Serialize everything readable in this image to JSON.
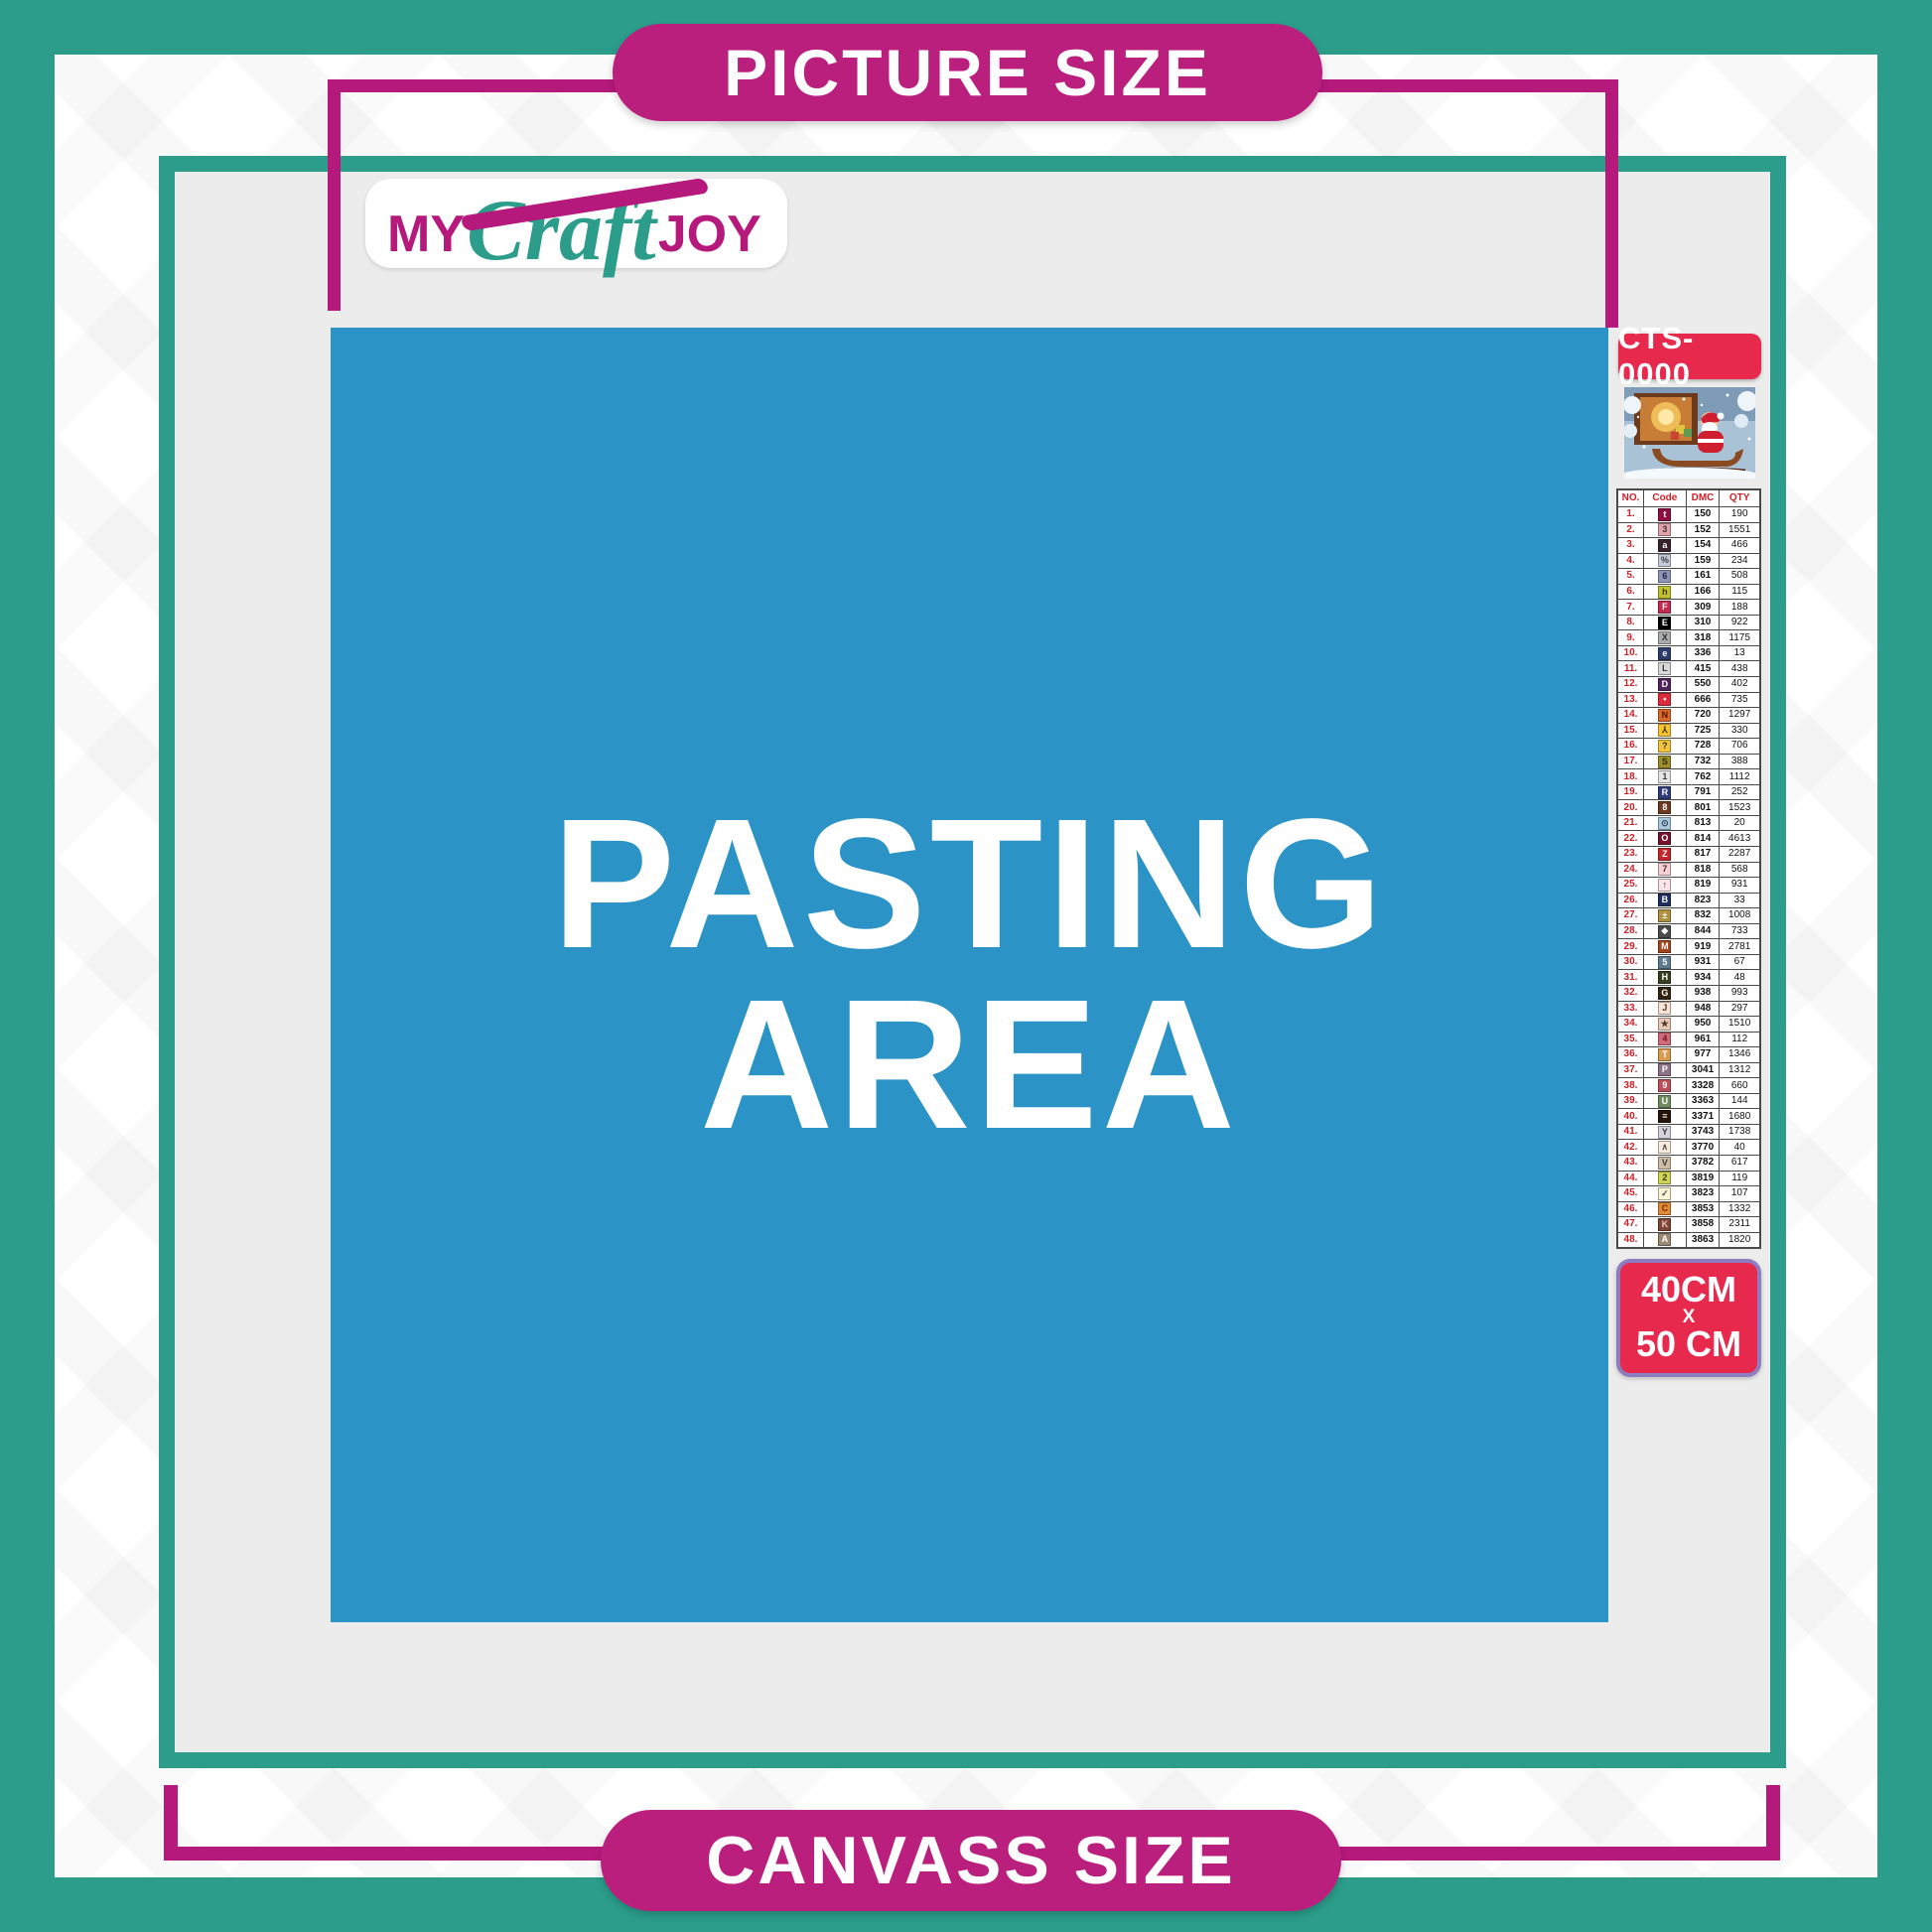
{
  "banners": {
    "top": "PICTURE SIZE",
    "bottom": "CANVASS SIZE"
  },
  "logo": {
    "word1": "MY",
    "word2": "Craft",
    "word3": "JOY"
  },
  "pasting_area": {
    "line1": "PASTING",
    "line2": "AREA"
  },
  "product": {
    "sku": "CTS-0000",
    "size_width": "40CM",
    "size_separator": "X",
    "size_height": "50 CM",
    "thumbnail": "santa-sleigh-christmas-scene"
  },
  "colors": {
    "teal_frame": "#2b9d8a",
    "magenta_accent": "#b5197c",
    "pill_magenta": "#bb1f7e",
    "pasting_blue": "#2b93c5",
    "badge_red": "#e8294e",
    "badge_border_purple": "#8d7cc0",
    "canvas_gray": "#ececec",
    "table_header_red": "#cc2027"
  },
  "color_table": {
    "headers": [
      "NO.",
      "Code",
      "DMC",
      "QTY"
    ],
    "rows": [
      {
        "no": "1.",
        "symbol": "t",
        "bg": "#8e1043",
        "fg": "#ffffff",
        "dmc": "150",
        "qty": "190"
      },
      {
        "no": "2.",
        "symbol": "3",
        "bg": "#e0a3a8",
        "fg": "#3a3a3a",
        "dmc": "152",
        "qty": "1551"
      },
      {
        "no": "3.",
        "symbol": "a",
        "bg": "#38222e",
        "fg": "#ffffff",
        "dmc": "154",
        "qty": "466"
      },
      {
        "no": "4.",
        "symbol": "%",
        "bg": "#c6cada",
        "fg": "#3a3a3a",
        "dmc": "159",
        "qty": "234"
      },
      {
        "no": "5.",
        "symbol": "6",
        "bg": "#8e96b8",
        "fg": "#1d2440",
        "dmc": "161",
        "qty": "508"
      },
      {
        "no": "6.",
        "symbol": "h",
        "bg": "#bfc22e",
        "fg": "#3a3a00",
        "dmc": "166",
        "qty": "115"
      },
      {
        "no": "7.",
        "symbol": "F",
        "bg": "#c22a50",
        "fg": "#ffffff",
        "dmc": "309",
        "qty": "188"
      },
      {
        "no": "8.",
        "symbol": "E",
        "bg": "#000000",
        "fg": "#ffffff",
        "dmc": "310",
        "qty": "922"
      },
      {
        "no": "9.",
        "symbol": "X",
        "bg": "#aaacae",
        "fg": "#2e2e2e",
        "dmc": "318",
        "qty": "1175"
      },
      {
        "no": "10.",
        "symbol": "e",
        "bg": "#2c3b6c",
        "fg": "#ffffff",
        "dmc": "336",
        "qty": "13"
      },
      {
        "no": "11.",
        "symbol": "L",
        "bg": "#d7d8da",
        "fg": "#3a3a3a",
        "dmc": "415",
        "qty": "438"
      },
      {
        "no": "12.",
        "symbol": "D",
        "bg": "#50215b",
        "fg": "#ffffff",
        "dmc": "550",
        "qty": "402"
      },
      {
        "no": "13.",
        "symbol": "•",
        "bg": "#dd2b3b",
        "fg": "#ffffff",
        "dmc": "666",
        "qty": "735"
      },
      {
        "no": "14.",
        "symbol": "N",
        "bg": "#d9692a",
        "fg": "#571403",
        "dmc": "720",
        "qty": "1297"
      },
      {
        "no": "15.",
        "symbol": "⅄",
        "bg": "#f5c231",
        "fg": "#3d2f00",
        "dmc": "725",
        "qty": "330"
      },
      {
        "no": "16.",
        "symbol": "?",
        "bg": "#f1c43e",
        "fg": "#3d2f00",
        "dmc": "728",
        "qty": "706"
      },
      {
        "no": "17.",
        "symbol": "S",
        "bg": "#9c8e2b",
        "fg": "#2f2a00",
        "dmc": "732",
        "qty": "388"
      },
      {
        "no": "18.",
        "symbol": "1",
        "bg": "#e5e5e5",
        "fg": "#3a3a3a",
        "dmc": "762",
        "qty": "1112"
      },
      {
        "no": "19.",
        "symbol": "R",
        "bg": "#2f3c79",
        "fg": "#ffffff",
        "dmc": "791",
        "qty": "252"
      },
      {
        "no": "20.",
        "symbol": "8",
        "bg": "#6d3a21",
        "fg": "#ffffff",
        "dmc": "801",
        "qty": "1523"
      },
      {
        "no": "21.",
        "symbol": "⊙",
        "bg": "#a9c7de",
        "fg": "#2c3e52",
        "dmc": "813",
        "qty": "20"
      },
      {
        "no": "22.",
        "symbol": "O",
        "bg": "#75112e",
        "fg": "#ffffff",
        "dmc": "814",
        "qty": "4613"
      },
      {
        "no": "23.",
        "symbol": "Z",
        "bg": "#c4252a",
        "fg": "#ffffff",
        "dmc": "817",
        "qty": "2287"
      },
      {
        "no": "24.",
        "symbol": "7",
        "bg": "#f7d0d5",
        "fg": "#4a3034",
        "dmc": "818",
        "qty": "568"
      },
      {
        "no": "25.",
        "symbol": "↑",
        "bg": "#f9e4e7",
        "fg": "#4a3034",
        "dmc": "819",
        "qty": "931"
      },
      {
        "no": "26.",
        "symbol": "B",
        "bg": "#202e5f",
        "fg": "#ffffff",
        "dmc": "823",
        "qty": "33"
      },
      {
        "no": "27.",
        "symbol": "±",
        "bg": "#b1903f",
        "fg": "#ffffff",
        "dmc": "832",
        "qty": "1008"
      },
      {
        "no": "28.",
        "symbol": "❖",
        "bg": "#4b4b4b",
        "fg": "#ffffff",
        "dmc": "844",
        "qty": "733"
      },
      {
        "no": "29.",
        "symbol": "M",
        "bg": "#a1471f",
        "fg": "#ffffff",
        "dmc": "919",
        "qty": "2781"
      },
      {
        "no": "30.",
        "symbol": "5",
        "bg": "#5d7c90",
        "fg": "#ffffff",
        "dmc": "931",
        "qty": "67"
      },
      {
        "no": "31.",
        "symbol": "H",
        "bg": "#364020",
        "fg": "#ffffff",
        "dmc": "934",
        "qty": "48"
      },
      {
        "no": "32.",
        "symbol": "G",
        "bg": "#332210",
        "fg": "#ffffff",
        "dmc": "938",
        "qty": "993"
      },
      {
        "no": "33.",
        "symbol": "J",
        "bg": "#fae3d4",
        "fg": "#4a3a2a",
        "dmc": "948",
        "qty": "297"
      },
      {
        "no": "34.",
        "symbol": "★",
        "bg": "#e7c9b5",
        "fg": "#4a3a2a",
        "dmc": "950",
        "qty": "1510"
      },
      {
        "no": "35.",
        "symbol": "4",
        "bg": "#d16b7a",
        "fg": "#6e1324",
        "dmc": "961",
        "qty": "112"
      },
      {
        "no": "36.",
        "symbol": "T",
        "bg": "#d89b4f",
        "fg": "#ffffff",
        "dmc": "977",
        "qty": "1346"
      },
      {
        "no": "37.",
        "symbol": "P",
        "bg": "#8e7287",
        "fg": "#ffffff",
        "dmc": "3041",
        "qty": "1312"
      },
      {
        "no": "38.",
        "symbol": "9",
        "bg": "#bc505a",
        "fg": "#ffffff",
        "dmc": "3328",
        "qty": "660"
      },
      {
        "no": "39.",
        "symbol": "U",
        "bg": "#708b5f",
        "fg": "#ffffff",
        "dmc": "3363",
        "qty": "144"
      },
      {
        "no": "40.",
        "symbol": "≡",
        "bg": "#251509",
        "fg": "#ffffff",
        "dmc": "3371",
        "qty": "1680"
      },
      {
        "no": "41.",
        "symbol": "Y",
        "bg": "#d6d3de",
        "fg": "#3a3a3a",
        "dmc": "3743",
        "qty": "1738"
      },
      {
        "no": "42.",
        "symbol": "∧",
        "bg": "#f9ebd9",
        "fg": "#4a4a4a",
        "dmc": "3770",
        "qty": "40"
      },
      {
        "no": "43.",
        "symbol": "V",
        "bg": "#cebba3",
        "fg": "#3a3a3a",
        "dmc": "3782",
        "qty": "617"
      },
      {
        "no": "44.",
        "symbol": "2",
        "bg": "#d0d556",
        "fg": "#3a3a00",
        "dmc": "3819",
        "qty": "119"
      },
      {
        "no": "45.",
        "symbol": "✓",
        "bg": "#fbf5d5",
        "fg": "#4a4a4a",
        "dmc": "3823",
        "qty": "107"
      },
      {
        "no": "46.",
        "symbol": "C",
        "bg": "#e18b36",
        "fg": "#7c2a00",
        "dmc": "3853",
        "qty": "1332"
      },
      {
        "no": "47.",
        "symbol": "K",
        "bg": "#7d4437",
        "fg": "#e8c8b8",
        "dmc": "3858",
        "qty": "2311"
      },
      {
        "no": "48.",
        "symbol": "A",
        "bg": "#9c8773",
        "fg": "#ffffff",
        "dmc": "3863",
        "qty": "1820"
      }
    ]
  }
}
